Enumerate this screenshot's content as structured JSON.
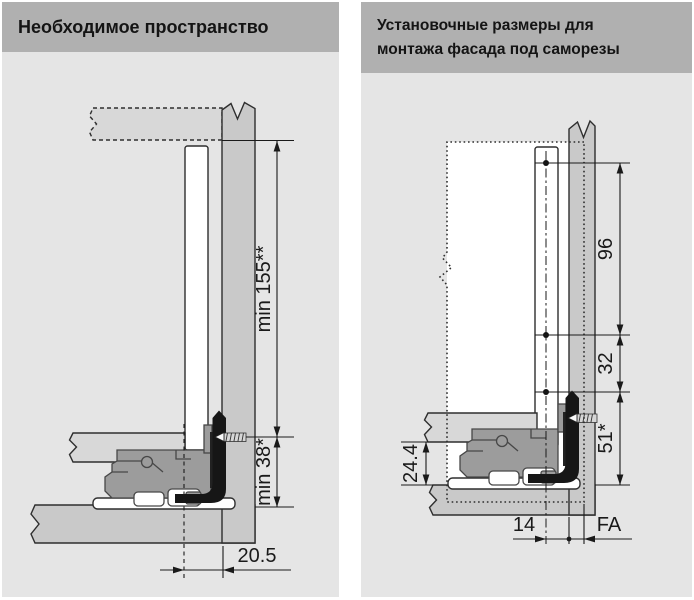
{
  "panels": {
    "left": {
      "title": "Необходимое пространство",
      "dims": {
        "min_height": "min 155**",
        "min_bottom": "min 38*",
        "gap": "20.5"
      }
    },
    "right": {
      "title_line1": "Установочные размеры для",
      "title_line2": "монтажа фасада под саморезы",
      "dims": {
        "hole_span_top": "96",
        "hole_span_mid": "32",
        "hole_span_bottom": "51*",
        "base_height": "24.4",
        "screw_offset": "14",
        "front_overlay": "FA"
      }
    }
  },
  "colors": {
    "header_bg": "#b0b0b0",
    "panel_bg": "#e5e5e5",
    "wood_fill": "#c9c9c9",
    "light_fill": "#d8d8d8",
    "mechanism_fill": "#9c9c9c",
    "bracket_black": "#161616",
    "line": "#2e2e2e",
    "dim_line": "#1a1a1a",
    "white": "#ffffff"
  }
}
